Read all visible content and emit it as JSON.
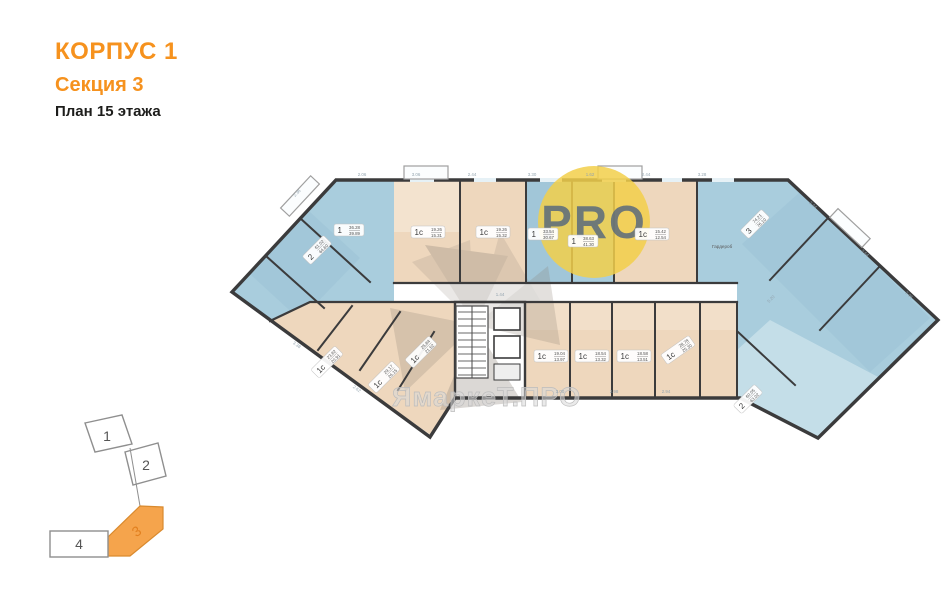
{
  "title": {
    "building": "КОРПУС 1",
    "section": "Секция 3",
    "floor": "План 15 этажа"
  },
  "logo": {
    "text": "PRO"
  },
  "watermark": {
    "text": "ЯмаркеТ.ПРО"
  },
  "plan": {
    "room_label": "Гардероб"
  },
  "minimap": {
    "highlighted_section": "3",
    "sections": [
      {
        "label": "1"
      },
      {
        "label": "2"
      },
      {
        "label": "3"
      },
      {
        "label": "4"
      }
    ]
  },
  "colors": {
    "accent_orange": "#f6921e",
    "plan_blue": "#a9cddd",
    "plan_blue_dark": "#9cc2d6",
    "plan_blue_light": "#c9e0ea",
    "plan_beige": "#eed7bd",
    "plan_beige_light": "#f3e3cf",
    "wall": "#3b3b3c",
    "logo_yellow": "#f2cf4a",
    "logo_text": "#51647e",
    "minimap_orange": "#f5a44c",
    "minimap_number_orange": "#e2801f"
  },
  "apartments": [
    {
      "t": "2",
      "a1": "61.02",
      "a2": "64.60",
      "x": 317,
      "y": 250,
      "r": -45
    },
    {
      "t": "1",
      "a1": "36.28",
      "a2": "39.89",
      "x": 349,
      "y": 230,
      "r": 0
    },
    {
      "t": "1с",
      "a1": "19.26",
      "a2": "15.31",
      "x": 428,
      "y": 232,
      "r": 0
    },
    {
      "t": "1с",
      "a1": "19.26",
      "a2": "15.32",
      "x": 493,
      "y": 232,
      "r": 0
    },
    {
      "t": "1",
      "a1": "33.54",
      "a2": "30.67",
      "x": 543,
      "y": 234,
      "r": 0
    },
    {
      "t": "1",
      "a1": "38.63",
      "a2": "41.30",
      "x": 583,
      "y": 241,
      "r": 0
    },
    {
      "t": "1с",
      "a1": "15.42",
      "a2": "12.54",
      "x": 652,
      "y": 234,
      "r": 0
    },
    {
      "t": "3",
      "a1": "74.21",
      "a2": "76.10",
      "x": 755,
      "y": 224,
      "r": -45
    },
    {
      "t": "2",
      "a1": "60.05",
      "a2": "63.02",
      "x": 748,
      "y": 399,
      "r": -45
    },
    {
      "t": "1с",
      "a1": "19.04",
      "a2": "13.97",
      "x": 551,
      "y": 356,
      "r": 0
    },
    {
      "t": "1с",
      "a1": "18.54",
      "a2": "13.32",
      "x": 592,
      "y": 356,
      "r": 0
    },
    {
      "t": "1с",
      "a1": "18.58",
      "a2": "13.51",
      "x": 634,
      "y": 356,
      "r": 0
    },
    {
      "t": "1с",
      "a1": "28.78",
      "a2": "25.30",
      "x": 678,
      "y": 350,
      "r": -35
    },
    {
      "t": "1с",
      "a1": "23.82",
      "a2": "20.91",
      "x": 327,
      "y": 362,
      "r": -45
    },
    {
      "t": "1с",
      "a1": "29.17",
      "a2": "26.15",
      "x": 384,
      "y": 377,
      "r": -45
    },
    {
      "t": "1с",
      "a1": "25.84",
      "a2": "21.52",
      "x": 421,
      "y": 352,
      "r": -45
    }
  ],
  "dimensions": [
    {
      "t": "2.36",
      "x": 298,
      "y": 194,
      "r": -45
    },
    {
      "t": "2.06",
      "x": 362,
      "y": 176,
      "r": 0
    },
    {
      "t": "3.06",
      "x": 416,
      "y": 176,
      "r": 0
    },
    {
      "t": "2.44",
      "x": 472,
      "y": 176,
      "r": 0
    },
    {
      "t": "3.30",
      "x": 532,
      "y": 176,
      "r": 0
    },
    {
      "t": "1.62",
      "x": 590,
      "y": 176,
      "r": 0
    },
    {
      "t": "2.44",
      "x": 646,
      "y": 176,
      "r": 0
    },
    {
      "t": "3.28",
      "x": 702,
      "y": 176,
      "r": 0
    },
    {
      "t": "2.44",
      "x": 812,
      "y": 206,
      "r": 43
    },
    {
      "t": "3.64",
      "x": 864,
      "y": 254,
      "r": 43
    },
    {
      "t": "2.06",
      "x": 908,
      "y": 296,
      "r": 43
    },
    {
      "t": "3.00",
      "x": 560,
      "y": 393,
      "r": 0
    },
    {
      "t": "2.98",
      "x": 614,
      "y": 393,
      "r": 0
    },
    {
      "t": "2.94",
      "x": 666,
      "y": 393,
      "r": 0
    },
    {
      "t": "3.38",
      "x": 296,
      "y": 346,
      "r": 36
    },
    {
      "t": "2.62",
      "x": 356,
      "y": 390,
      "r": 36
    },
    {
      "t": "1.44",
      "x": 500,
      "y": 296,
      "r": 0
    },
    {
      "t": "5.20",
      "x": 772,
      "y": 300,
      "r": -45
    }
  ]
}
